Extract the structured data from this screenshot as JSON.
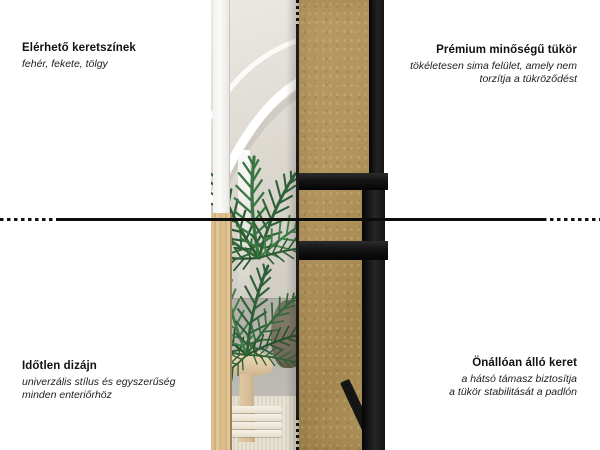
{
  "labels": {
    "top_left": {
      "title": "Elérhető keretszínek",
      "subtitle": "fehér, fekete, tölgy"
    },
    "top_right": {
      "title": "Prémium minőségű tükör",
      "subtitle1": "tökéletesen sima felület, amely nem",
      "subtitle2": "torzítja a tükröződést"
    },
    "bottom_left": {
      "title": "Időtlen dizájn",
      "subtitle1": "univerzális stílus és egyszerűség",
      "subtitle2": "minden enteriőrhöz"
    },
    "bottom_right": {
      "title": "Önállóan álló keret",
      "subtitle1": "a hátsó támasz biztosítja",
      "subtitle2": "a tükör stabilitását a padlón"
    }
  },
  "colors": {
    "bg": "#ffffff",
    "text": "#111111",
    "line": "#0c0c0c",
    "frame_black": "#151515",
    "mdf": "#b2955f",
    "oak": "#ddbf8e",
    "white_frame": "#fbfbfa",
    "floor": "#b3b0aa",
    "rug": "#e8e3d5",
    "blanket": "#f5f1e7",
    "stool_wood": "#e0caa6",
    "pot": "#716858",
    "plant_green": "#2e5f36",
    "plant_green_dark": "#25512c",
    "plant_green_light": "#3f7b46"
  }
}
